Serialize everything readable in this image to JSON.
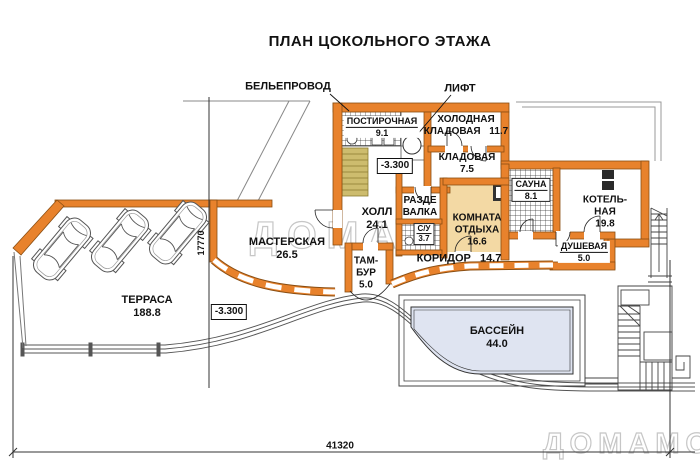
{
  "title": "ПЛАН ЦОКОЛЬНОГО ЭТАЖА",
  "watermark": "ДОМАМО",
  "callouts": {
    "laundry_chute": "БЕЛЬЕПРОВОД",
    "lift": "ЛИФТ"
  },
  "elevation_marks": {
    "floor": "-3.300",
    "terrace": "-3.300"
  },
  "dimensions": {
    "overall_width": "41320",
    "overall_depth": "17770"
  },
  "rooms": {
    "postirochnaya": {
      "name": "ПОСТИРОЧНАЯ",
      "area": "9.1"
    },
    "holodnaya_kladovaya": {
      "name": "ХОЛОДНАЯ\nКЛАДОВАЯ",
      "area": "11.7"
    },
    "kladovaya": {
      "name": "КЛАДОВАЯ",
      "area": "7.5"
    },
    "sauna": {
      "name": "САУНА",
      "area": "8.1"
    },
    "kotelnaya": {
      "name": "КОТЕЛЬ-\nНАЯ",
      "area": "19.8"
    },
    "dushevaya": {
      "name": "ДУШЕВАЯ",
      "area": "5.0"
    },
    "razdevalka": {
      "name": "РАЗДЕ\nВАЛКА",
      "area": ""
    },
    "komnata_otdyha": {
      "name": "КОМНАТА\nОТДЫХА",
      "area": "16.6"
    },
    "su": {
      "name": "С/У",
      "area": "3.7"
    },
    "holl": {
      "name": "ХОЛЛ",
      "area": "24.1"
    },
    "tambur": {
      "name": "ТАМ-\nБУР",
      "area": "5.0"
    },
    "koridor": {
      "name": "КОРИДОР",
      "area": "14.7"
    },
    "masterskaya": {
      "name": "МАСТЕРСКАЯ",
      "area": "26.5"
    },
    "terrasa": {
      "name": "ТЕРРАСА",
      "area": "188.8"
    },
    "bassein": {
      "name": "БАССЕЙН",
      "area": "44.0"
    }
  },
  "colors": {
    "wall_orange": "#E8822C",
    "floor_peach": "#F3D9A4",
    "stair_khaki": "#CDBC6E",
    "pool_water": "#DFE4F1",
    "watermark_gray": "#C6C6C6"
  }
}
